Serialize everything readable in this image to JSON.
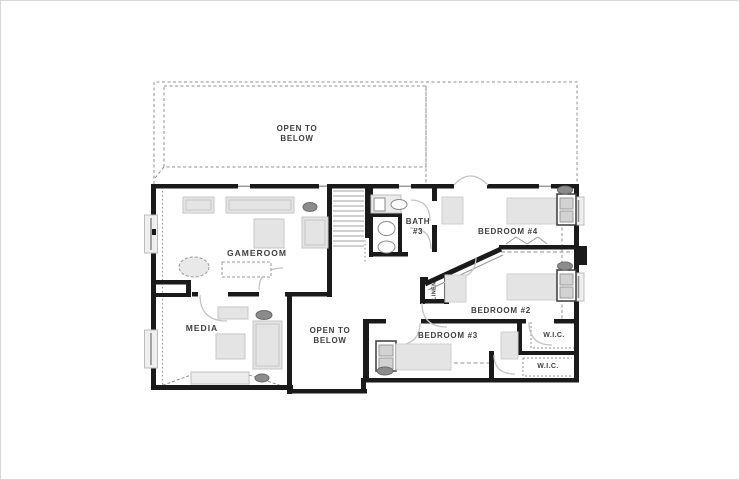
{
  "labels": {
    "open_to_below_top": "OPEN TO\nBELOW",
    "gameroom": "GAMEROOM",
    "media": "MEDIA",
    "open_to_below_center": "OPEN TO\nBELOW",
    "bath_3": "BATH\n#3",
    "bedroom_4": "BEDROOM #4",
    "bedroom_2": "BEDROOM #2",
    "bedroom_3": "BEDROOM #3",
    "wic_upper": "W.I.C.",
    "wic_lower": "W.I.C.",
    "linen": "LINEN"
  },
  "colors": {
    "background": "#ffffff",
    "wall": "#1a1a1a",
    "furniture_fill": "#e4e4e4",
    "furniture_stroke": "#c6c6c6",
    "dark_accent": "#8c8c8c",
    "dashed_line": "#909090",
    "door_swing": "#c4c4c4",
    "label_text": "#3e3e3e"
  }
}
